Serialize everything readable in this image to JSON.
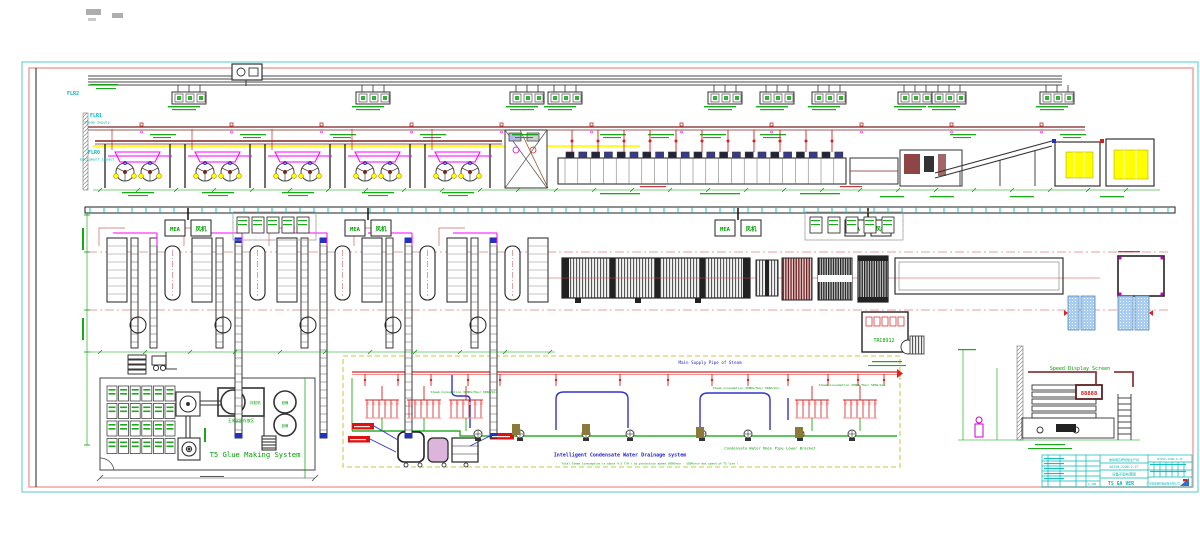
{
  "drawing": {
    "description": "CAD plant layout drawing of a corrugated/glue production line",
    "accent_colors": {
      "frame_outer": "#55c8c8",
      "frame_inner": "#f0a8a8",
      "steam_pipe": "#7a2525",
      "rail_yellow": "#ffff00",
      "machine_magenta": "#ff00ff",
      "dimension_green": "#00a000",
      "piping_red": "#dd2222",
      "piping_blue": "#3333cc",
      "title_cyan": "#00b8b8",
      "pallet_blue": "#a9cdf0",
      "stacker_yellow": "#ffff00"
    },
    "floor_labels": [
      {
        "code": "FLR2",
        "sub": ""
      },
      {
        "code": "FLR1",
        "sub": "Steam Supply"
      },
      {
        "code": "FLR0",
        "sub": "Equipment Layout"
      }
    ],
    "hangers_x": [
      172,
      356,
      510,
      548,
      708,
      760,
      812,
      898,
      932,
      1040
    ],
    "top_modules_x": [
      100,
      180,
      260,
      340,
      420
    ],
    "plan_modules_x": [
      105,
      190,
      275,
      360,
      445
    ],
    "plan_label_pairs_x": [
      165,
      345,
      715,
      845
    ],
    "comb_clusters_x": [
      365,
      407,
      449,
      795,
      843
    ],
    "pumps_x": [
      478,
      520,
      586,
      630,
      702,
      748,
      800,
      852
    ]
  },
  "labels": {
    "flr2": "FLR2",
    "flr1": "FLR1",
    "flr1_sub": "Steam Supply",
    "flr0": "FLR0",
    "flr0_sub": "Equipment Layout",
    "glue_system": "T5 Glue Making System",
    "speed_screen": "Speed Display Screen",
    "display_value": "88888",
    "steam_main": "Main Supply Pipe of Steam",
    "condensate_bracket": "Condensate Water Main Pipe Lower Bracket",
    "drainage_title": "Intelligent Condensate Water Drainage system",
    "drainage_note": "Total Steam Consumption is about 4.5 T/H ( by production speed 300M/min - 350M/min max speed of T5 line )",
    "steam_consumption": "Steam Consumption 300KG/Hour 500m/min",
    "trc_code": "TRC8912",
    "box_mea": "MEA",
    "box_fan": "风机",
    "tank_label": "拌胶机",
    "drum_label": "胶桶",
    "starch_area": "玉米淀粉存放区"
  },
  "title_block": {
    "line1": "玻璃钢瓦楞纸板生产线",
    "code": "WJ250-2200-2-1F",
    "sheet_name": "设备平面布置图",
    "version": "TS GA VER",
    "code_top": "WJ250-2200-2-1F",
    "company": "广东玻璃钢机械设备有限公司",
    "scale": "1:100"
  }
}
